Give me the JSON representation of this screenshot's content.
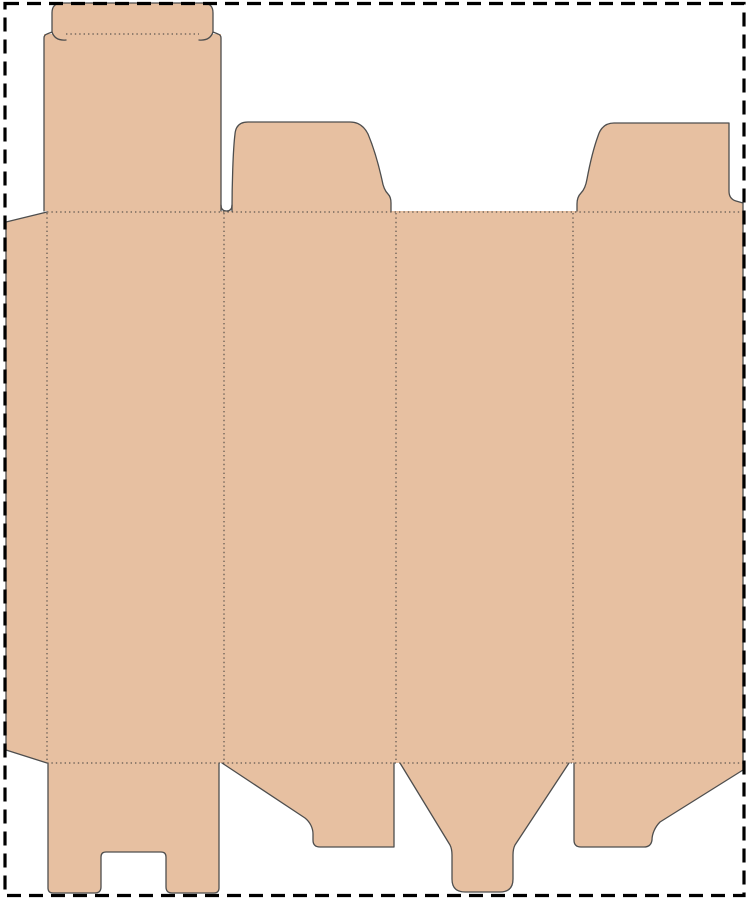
{
  "meta": {
    "title": "Folding carton box die-cut template (dieline)",
    "canvas": {
      "width": 747,
      "height": 900
    }
  },
  "colors": {
    "background": "#ffffff",
    "board_fill": "#e7c0a1",
    "cut_line": "#4e4e4e",
    "fold_line": "#3c3c3c",
    "page_border": "#000000"
  },
  "styles": {
    "cut_width": 1.3,
    "fold_width": 1,
    "fold_dash": "1.4 3",
    "border_width": 3.2,
    "border_dash": "14 8"
  },
  "page_border": {
    "x": 5,
    "y": 3.5,
    "width": 739,
    "height": 892
  },
  "pieces": [
    {
      "name": "body-panels",
      "d": "M 47 211 L 743 211 L 743 763 L 47 763 Z"
    },
    {
      "name": "glue-flap",
      "d": "M 47 212 L 6 222 L 6 750 L 47 763 Z"
    },
    {
      "name": "top-tuck-panel",
      "d": "M 44 34 L 221 34 L 221 211 L 44 211 Z"
    },
    {
      "name": "tuck-flap",
      "d": "M 52 34 L 52 13 Q 52 3 62 3 L 203 3 Q 213 3 213 13 L 213 34 Z"
    },
    {
      "name": "top-dust-flap-left",
      "d": "M 232 211 C 232 185 233 150 235 134 Q 236 122 248 122 L 350 122 Q 362 122 368 134 C 373 146 378 162 382 180 C 383 186 385 191 388 194 Q 391 197 391 203 L 391 211 Z"
    },
    {
      "name": "top-dust-flap-right",
      "d": "M 577 211 L 577 204 Q 577 197 581 193 C 584 190 586 185 587 179 C 590 163 594 147 598 136 Q 602 123 614 123 L 729 123 L 729 191 Q 729 199 736 201 L 743 203 L 743 211 Z"
    },
    {
      "name": "bottom-flap-1",
      "d": "M 48 763 L 48 888 Q 48 893 53 893 L 95 893 Q 101 893 101 887 L 101 857 Q 101 852 106 852 L 161 852 Q 166 852 166 857 L 166 887 Q 166 893 172 893 L 214 893 Q 219 893 219 888 L 219 763 Z"
    },
    {
      "name": "bottom-flap-2",
      "d": "M 222 763 L 305 818 C 310 822 313 828 313 834 L 313 840 Q 313 847 320 847 L 394 847 L 394 763 Z"
    },
    {
      "name": "bottom-flap-3-funnel",
      "d": "M 400 763 L 450 845 Q 452 849 452 855 L 452 879 Q 452 892 465 892 L 500 892 Q 513 892 513 879 L 513 855 Q 513 849 515 845 L 569 763 Z"
    },
    {
      "name": "bottom-flap-4",
      "d": "M 574 763 L 574 840 Q 574 847 581 847 L 644 847 Q 651 847 652 840 C 652 834 655 827 660 822 L 743 770 L 743 763 Z"
    }
  ],
  "cut_lines": [
    {
      "name": "glue-flap-cut",
      "d": "M 47 212 L 6 222 L 6 750 L 47 763"
    },
    {
      "name": "tuck-panel-cut",
      "d": "M 44 211 L 44 38 Q 44 35 47 34 L 52 32 L 52 13 Q 52 3 62 3 L 203 3 Q 213 3 213 13 L 213 32 L 218 34 Q 221 35 221 38 L 221 211"
    },
    {
      "name": "tuck-hook-left-cut",
      "d": "M 52 32 Q 55 41 66 40"
    },
    {
      "name": "tuck-hook-right-cut",
      "d": "M 213 32 Q 210 41 199 40"
    },
    {
      "name": "top-slit-u-cut",
      "d": "M 221 205 Q 221 211 226.5 211 Q 232 211 232 205"
    },
    {
      "name": "top-dust-flap-left-cut",
      "d": "M 232 211 C 232 185 233 150 235 134 Q 236 122 248 122 L 350 122 Q 362 122 368 134 C 373 146 378 162 382 180 C 383 186 385 191 388 194 Q 391 197 391 203 L 391 211"
    },
    {
      "name": "top-dust-flap-right-cut",
      "d": "M 577 211 L 577 204 Q 577 197 581 193 C 584 190 586 185 587 179 C 590 163 594 147 598 136 Q 602 123 614 123 L 729 123 L 729 191 Q 729 199 736 201 L 743 203"
    },
    {
      "name": "right-edge-bottom-flap-4-cut",
      "d": "M 743 203 L 743 770 L 660 822 C 655 827 652 834 652 840 Q 651 847 644 847 L 581 847 Q 574 847 574 840 L 574 763"
    },
    {
      "name": "bottom-funnel-cut",
      "d": "M 569 763 L 515 845 Q 513 849 513 855 L 513 879 Q 513 892 500 892 L 465 892 Q 452 892 452 879 L 452 855 Q 452 849 450 845 L 400 763"
    },
    {
      "name": "bottom-flap-2-cut",
      "d": "M 394 763 L 394 847 L 320 847 Q 313 847 313 840 L 313 834 C 313 828 310 822 305 818 L 222 763"
    },
    {
      "name": "bottom-flap-1-cut",
      "d": "M 219 763 L 219 888 Q 219 893 214 893 L 172 893 Q 166 893 166 887 L 166 857 Q 166 852 161 852 L 106 852 Q 101 852 101 857 L 101 887 Q 101 893 95 893 L 53 893 Q 48 893 48 888 L 48 763"
    }
  ],
  "fold_lines": [
    {
      "name": "top-horizontal-fold",
      "d": "M 47 212 L 743 212"
    },
    {
      "name": "bottom-horizontal-fold",
      "d": "M 47 763 L 743 763"
    },
    {
      "name": "glue-flap-fold",
      "d": "M 47 213 L 47 762"
    },
    {
      "name": "panel-fold-1",
      "d": "M 224 213 L 224 762"
    },
    {
      "name": "panel-fold-2",
      "d": "M 396 213 L 396 762"
    },
    {
      "name": "panel-fold-3",
      "d": "M 573 213 L 573 762"
    },
    {
      "name": "tuck-flap-fold",
      "d": "M 66 34 L 199 34"
    }
  ]
}
